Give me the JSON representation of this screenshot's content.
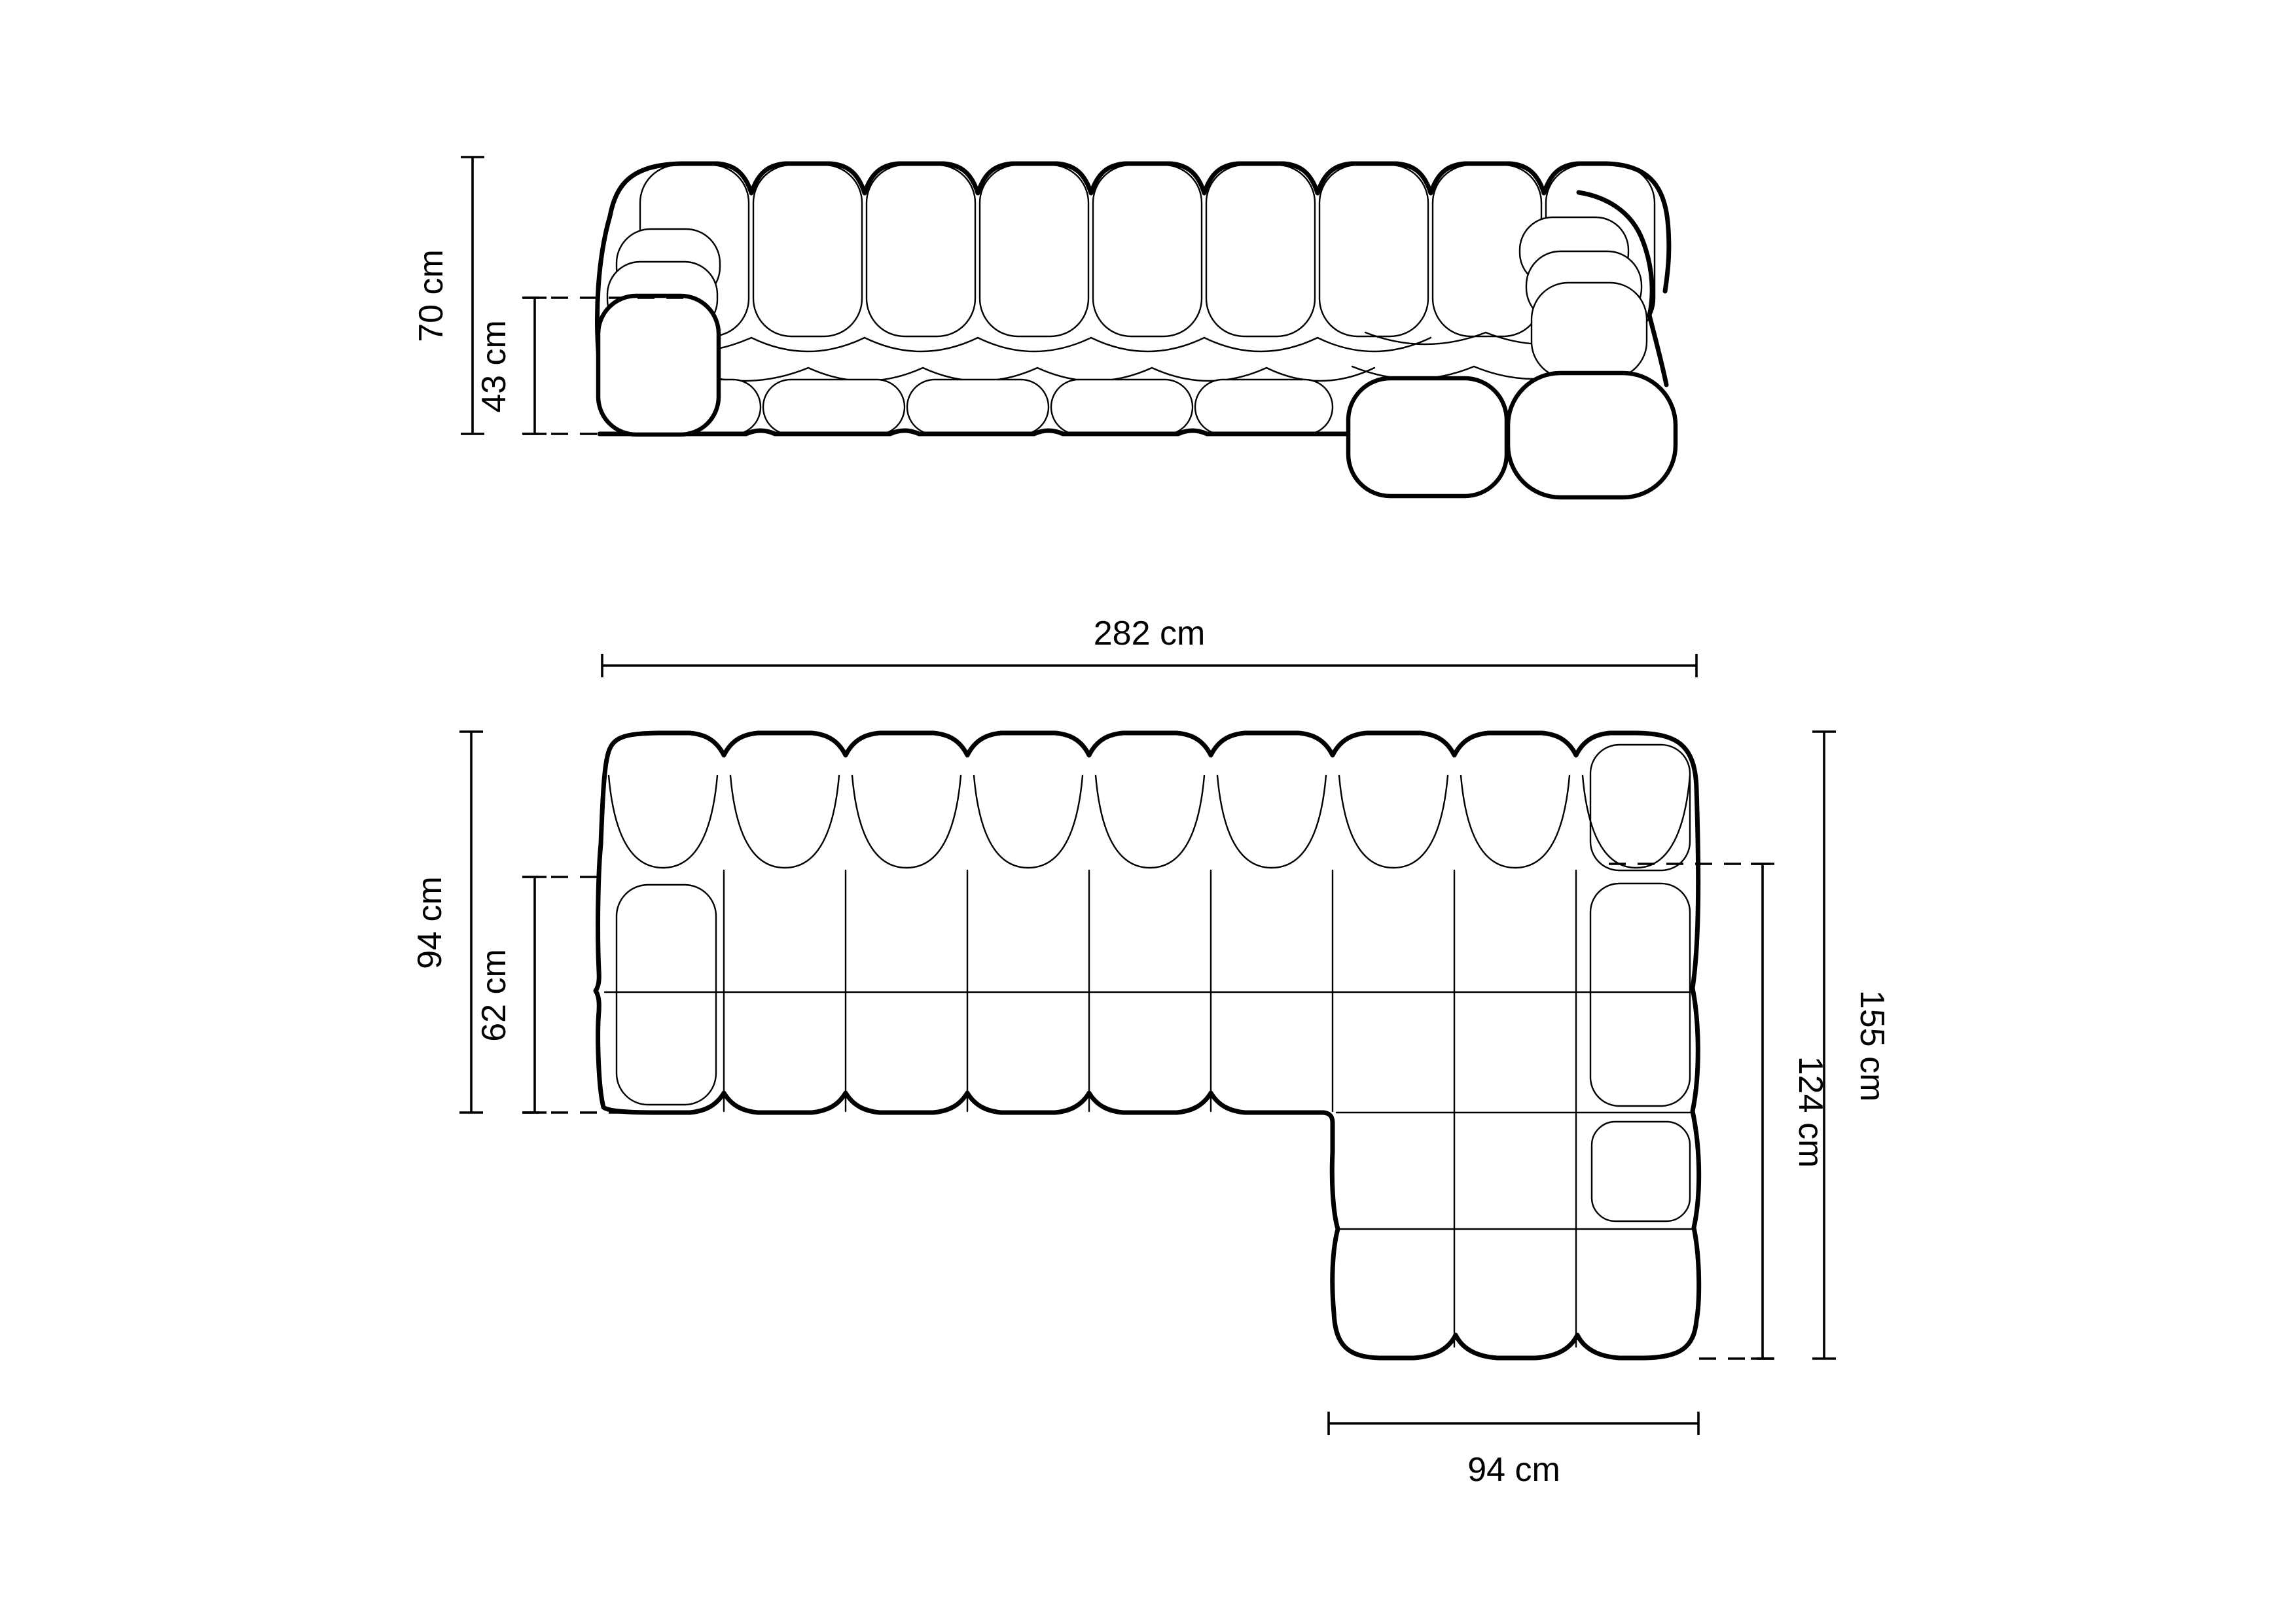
{
  "dims": {
    "front": {
      "overall_height": {
        "label": "70 cm",
        "value": 70,
        "unit": "cm"
      },
      "seat_height": {
        "label": "43 cm",
        "value": 43,
        "unit": "cm"
      }
    },
    "top": {
      "overall_width": {
        "label": "282 cm",
        "value": 282,
        "unit": "cm"
      },
      "overall_depth": {
        "label": "94 cm",
        "value": 94,
        "unit": "cm"
      },
      "seat_depth": {
        "label": "62 cm",
        "value": 62,
        "unit": "cm"
      },
      "right_side_total": {
        "label": "155 cm",
        "value": 155,
        "unit": "cm"
      },
      "chaise_extent": {
        "label": "124 cm",
        "value": 124,
        "unit": "cm"
      },
      "chaise_width": {
        "label": "94 cm",
        "value": 94,
        "unit": "cm"
      }
    },
    "colors": {
      "background": "#ffffff",
      "line": "#000000"
    }
  }
}
